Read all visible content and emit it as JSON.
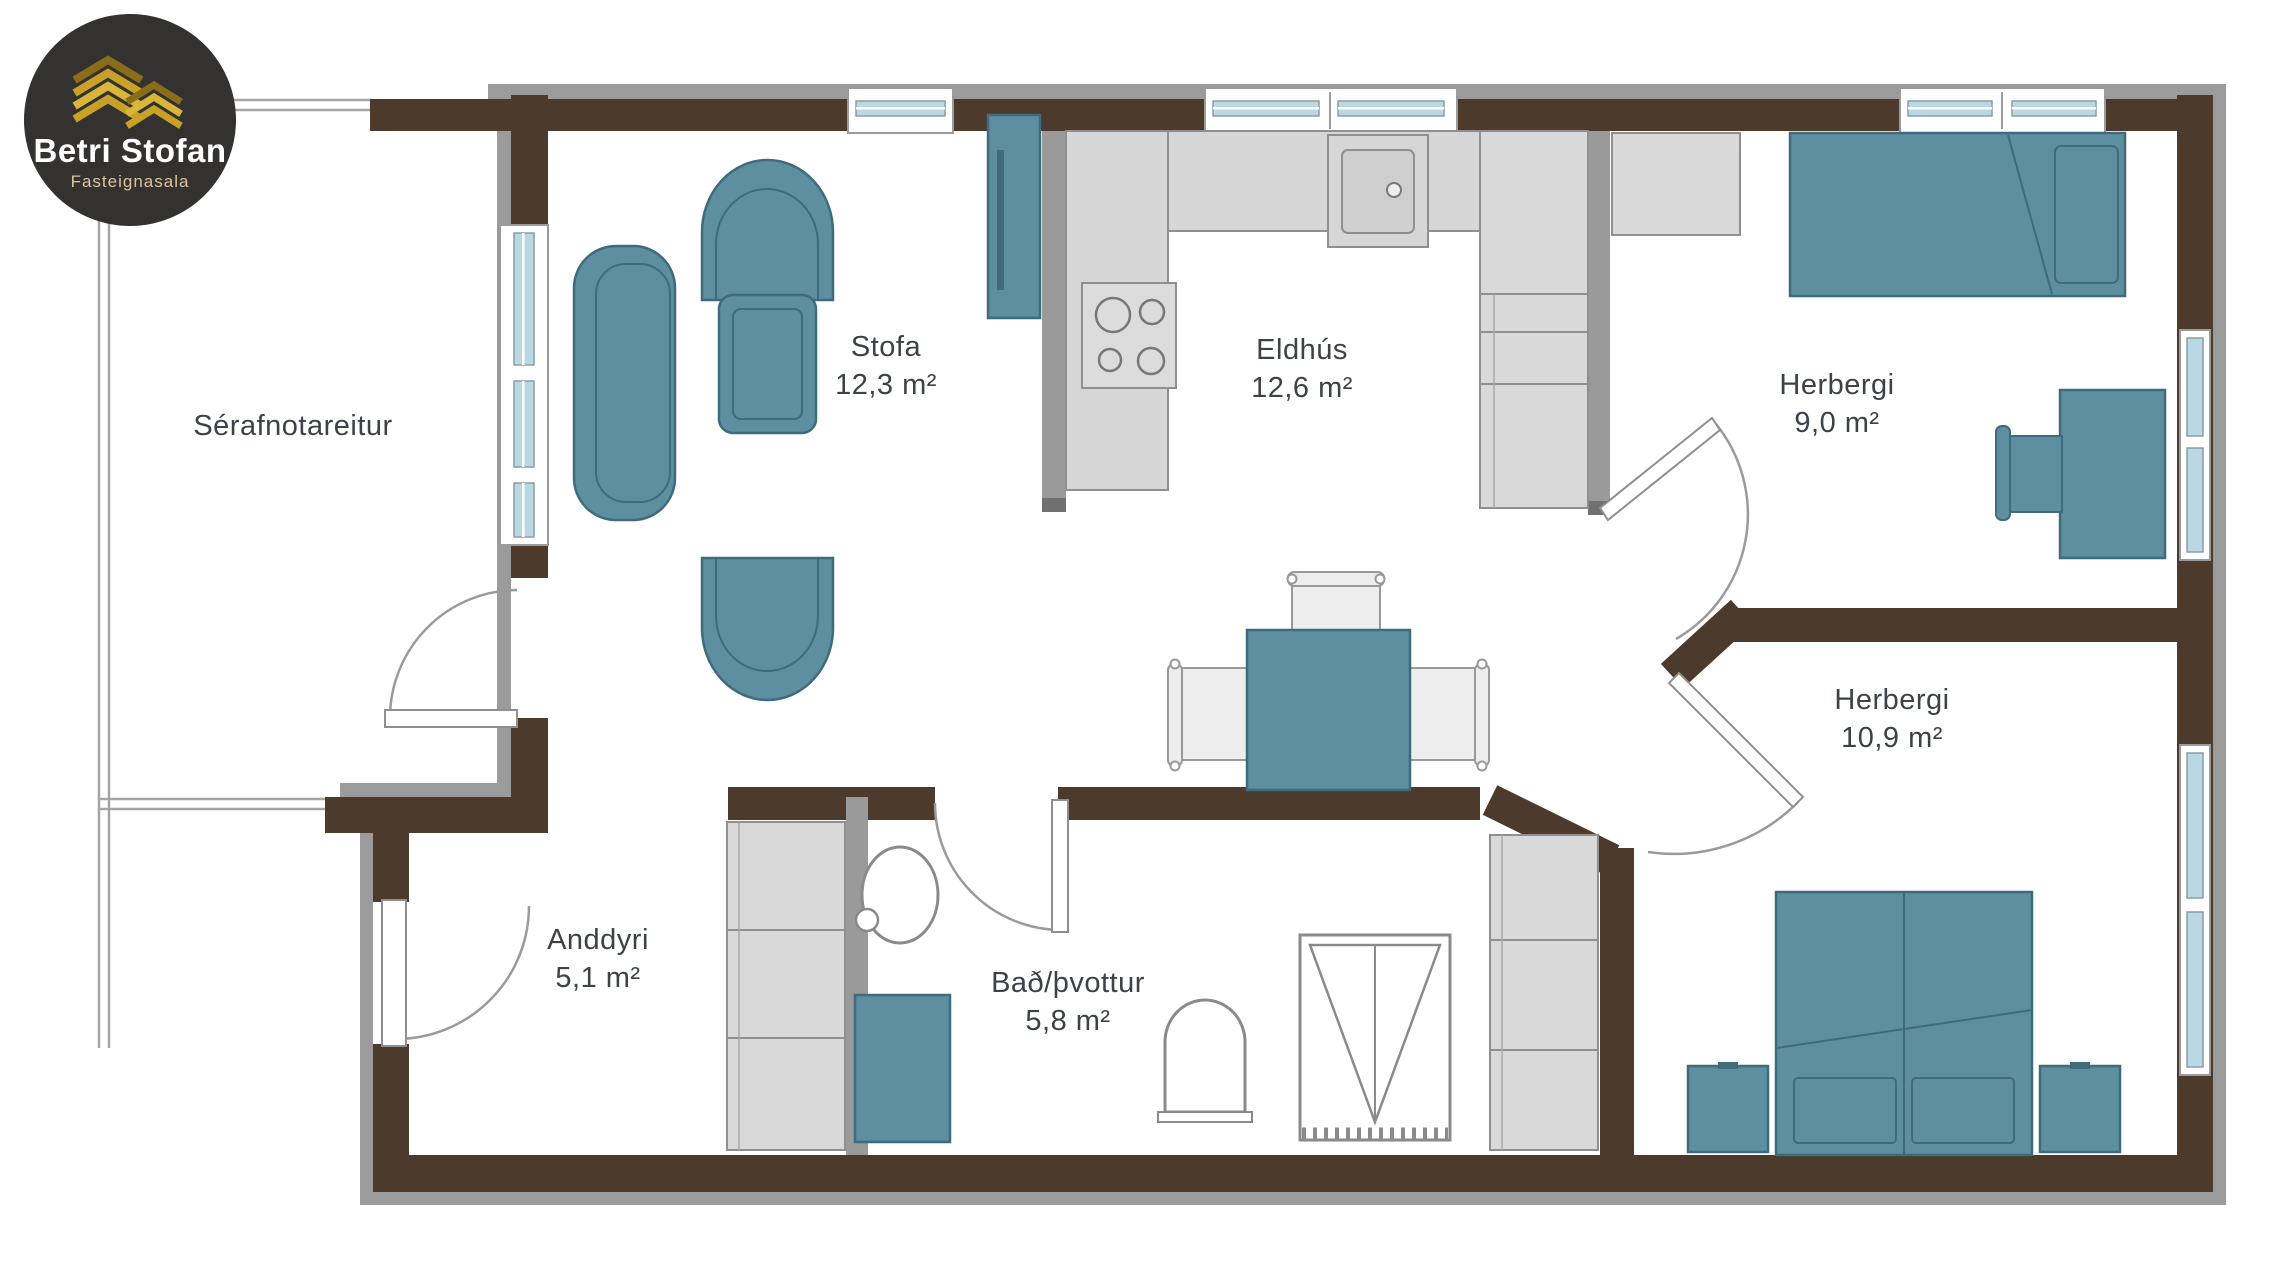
{
  "brand": {
    "name": "Betri Stofan",
    "tagline": "Fasteignasala"
  },
  "floor_plan": {
    "rooms": [
      {
        "name": "Sérafnotareitur",
        "area": ""
      },
      {
        "name": "Stofa",
        "area": "12,3 m²"
      },
      {
        "name": "Eldhús",
        "area": "12,6 m²"
      },
      {
        "name": "Herbergi",
        "area": "9,0 m²"
      },
      {
        "name": "Herbergi",
        "area": "10,9 m²"
      },
      {
        "name": "Anddyri",
        "area": "5,1 m²"
      },
      {
        "name": "Bað/þvottur",
        "area": "5,8 m²"
      }
    ],
    "colors": {
      "wall": "#4c3b2d",
      "exterior_band": "#9b9b9b",
      "partition": "#9a9a9a",
      "furniture": "#5d8fa1",
      "furniture_outline": "#3f6b7c",
      "counter": "#d6d6d6",
      "window_glass": "#b9d8e3",
      "text": "#3c4249",
      "logo_bg": "#343231",
      "logo_gold": "#c9a127"
    }
  }
}
